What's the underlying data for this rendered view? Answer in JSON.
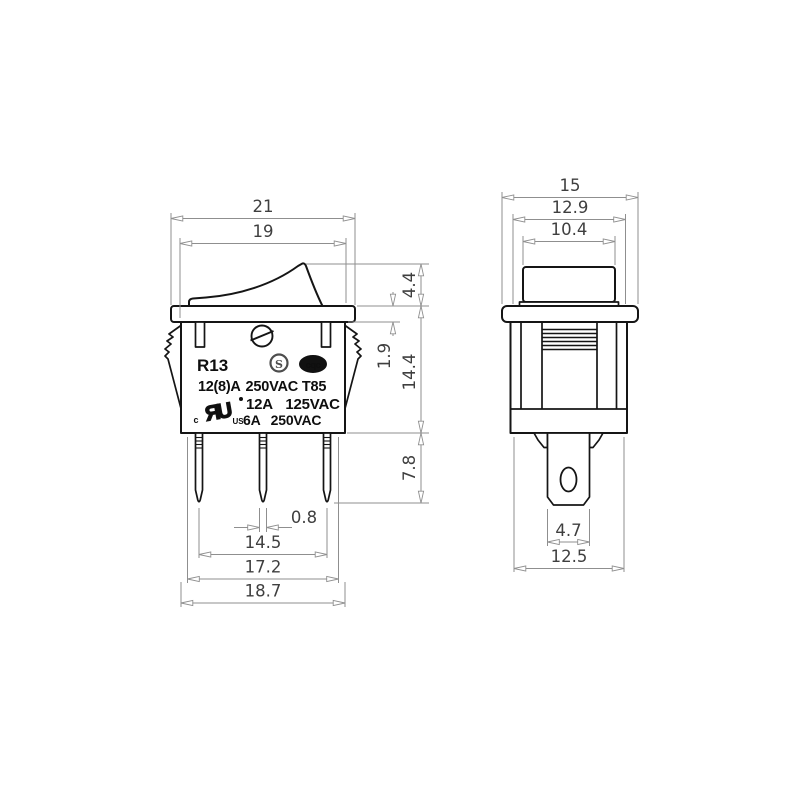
{
  "front_view": {
    "markings": {
      "model": "R13",
      "rating_line1_bold": "12(8)A",
      "rating_line1_rest": "250VAC T85",
      "rating_line2": "12A 125VAC",
      "rating_line3": "6A 250VAC",
      "s_mark": "S",
      "cqc_mark": "cqc",
      "ul_c": "c",
      "ul_mark": "ЯU",
      "ul_us": "US"
    },
    "dimensions": {
      "overall_width": "21",
      "inner_width": "19",
      "rocker_height": "4.4",
      "flange_thickness": "1.9",
      "body_depth": "14.4",
      "pin_length": "7.8",
      "pin_width": "0.8",
      "pin_pitch": "14.5",
      "body_width_lower": "17.2",
      "body_width_upper": "18.7"
    }
  },
  "side_view": {
    "dimensions": {
      "flange_width": "15",
      "body_width": "12.9",
      "rocker_width": "10.4",
      "stem_width": "4.7",
      "body_bottom_width": "12.5"
    }
  },
  "colors": {
    "outline": "#151515",
    "dimension_line": "#8f8f8f",
    "dimension_text": "#3f3f3f",
    "background": "#ffffff"
  }
}
